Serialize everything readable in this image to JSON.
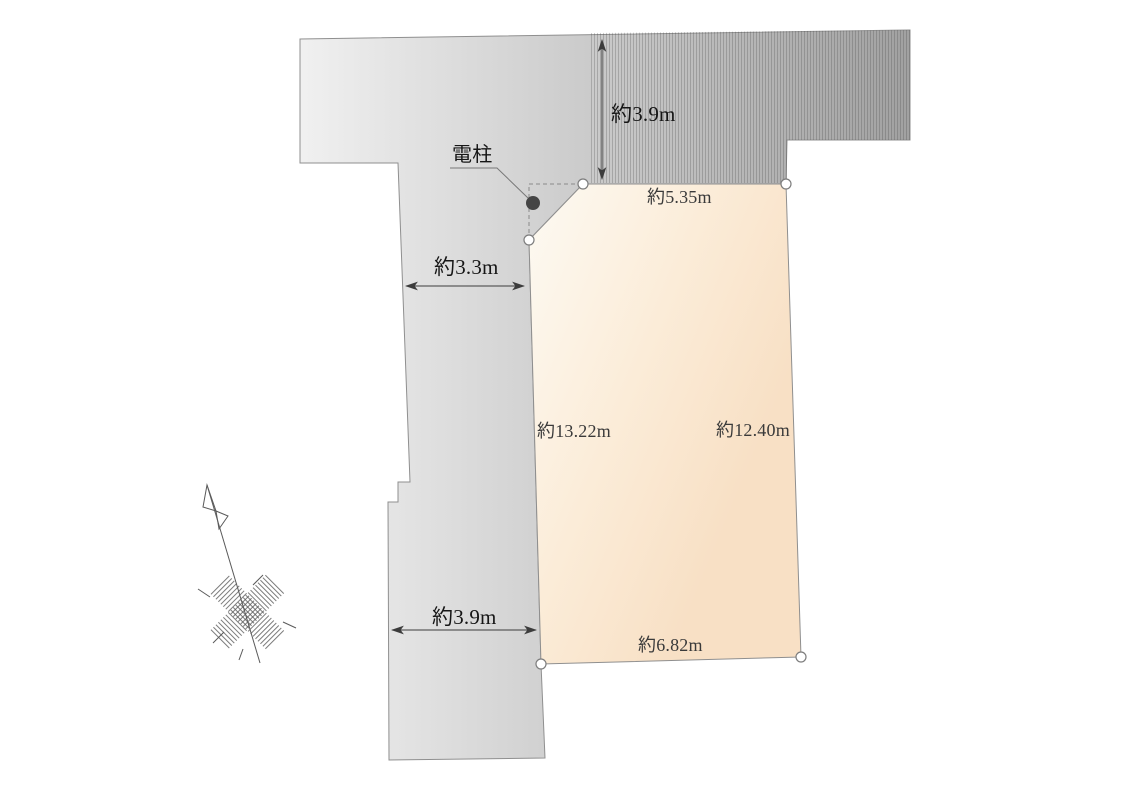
{
  "labels": {
    "road_top_width": "約3.9m",
    "boundary_top": "約5.35m",
    "road_left_width": "約3.3m",
    "boundary_left": "約13.22m",
    "boundary_right": "約12.40m",
    "boundary_bottom": "約6.82m",
    "road_bottom_width": "約3.9m",
    "utility_pole": "電柱"
  },
  "dimensions_m": {
    "road_top": 3.9,
    "boundary_top": 5.35,
    "road_left": 3.3,
    "boundary_left": 13.22,
    "boundary_right": 12.4,
    "boundary_bottom": 6.82,
    "road_bottom": 3.9
  },
  "icons": {
    "north_arrow": "hand-sketched north arrow with crosshatched star",
    "utility_pole_marker": "filled dark circle",
    "corner_marker": "small open circle"
  },
  "colors": {
    "road_light": "#f1f1f1",
    "road_mid": "#cdcdcd",
    "road_dark": "#a1a1a1",
    "parcel_light": "#fdfaf3",
    "parcel_mid": "#fbecd8",
    "parcel_dark": "#f8e0c5",
    "outline": "#8f8f8f",
    "dash": "#8a8a8a",
    "arrow": "#3c3c3c",
    "text_strong": "#161616",
    "text_dim": "#3a3a3a",
    "pole_fill": "#454545",
    "marker_stroke": "#7d7d7d",
    "sketch": "#5a5a5a"
  }
}
